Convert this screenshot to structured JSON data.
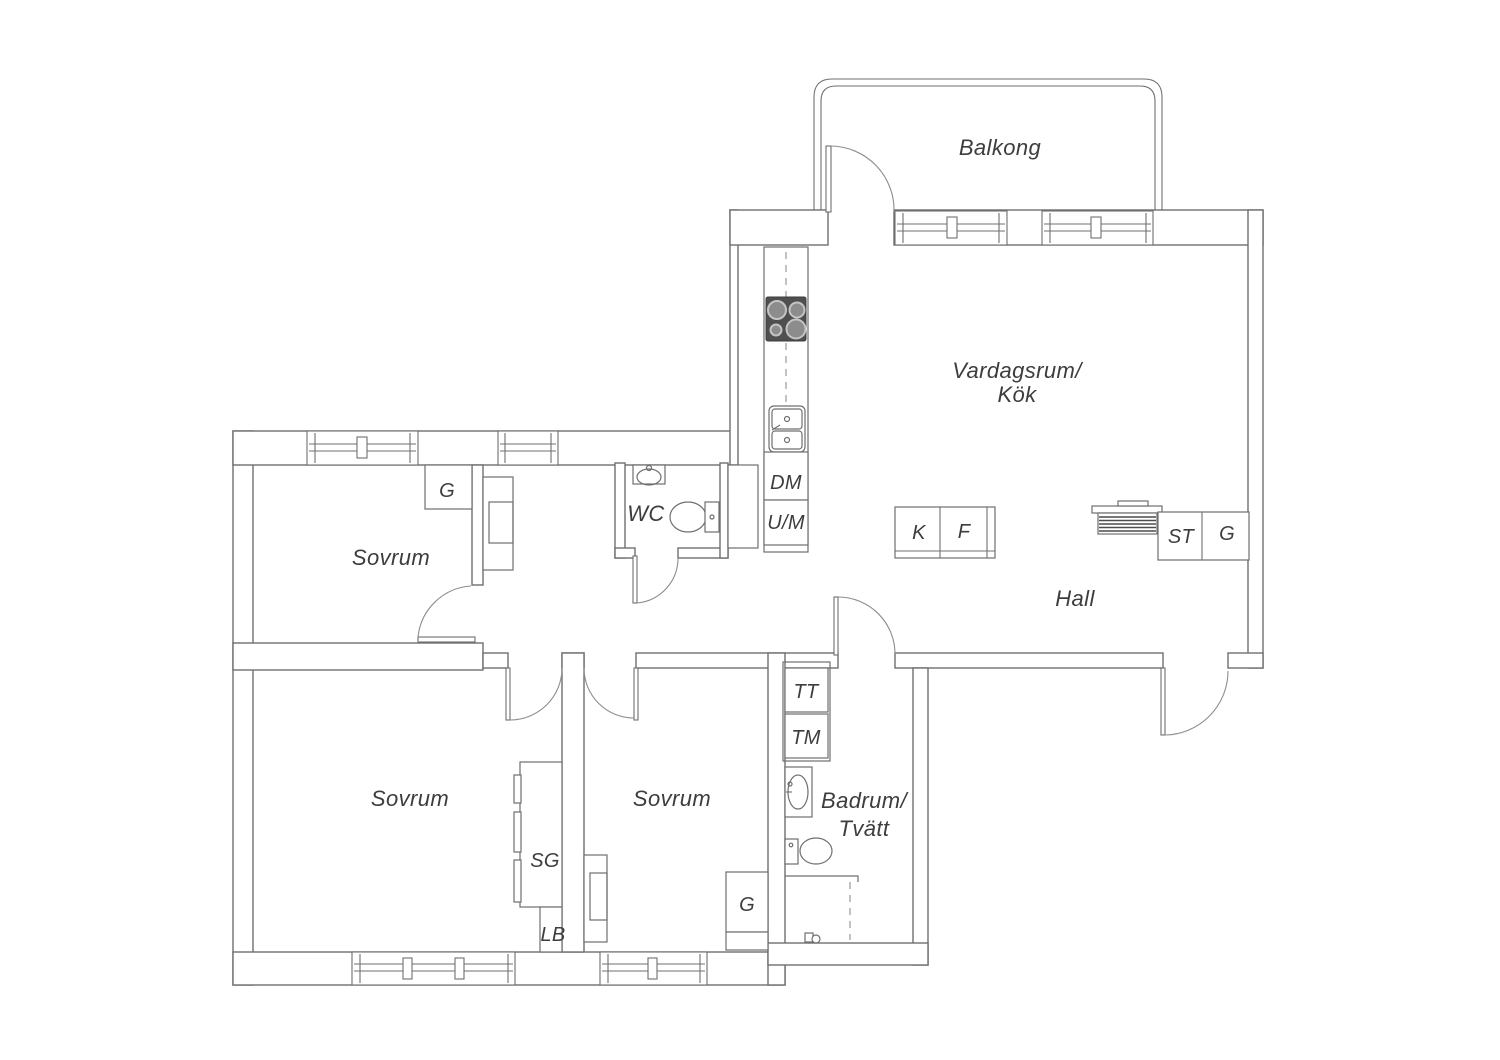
{
  "colors": {
    "background": "#ffffff",
    "wall_line": "#6f6f6f",
    "door_line": "#8d8d8d",
    "dashed_line": "#9a9a9a",
    "text": "#3d3d3d",
    "stove_body": "#4f4f4f",
    "stove_burner": "#8c8c8c"
  },
  "rooms": {
    "balcony": "Balkong",
    "living_kitchen_line1": "Vardagsrum/",
    "living_kitchen_line2": "Kök",
    "hall": "Hall",
    "wc": "WC",
    "bedroom1": "Sovrum",
    "bedroom2": "Sovrum",
    "bedroom3": "Sovrum",
    "bathroom_line1": "Badrum/",
    "bathroom_line2": "Tvätt"
  },
  "units": {
    "dishwasher": "DM",
    "oven_microwave": "U/M",
    "fridge": "K",
    "freezer": "F",
    "cleaning_cabinet": "ST",
    "wardrobe_hall": "G",
    "wardrobe_bedroom1": "G",
    "wardrobe_bedroom3": "G",
    "dryer": "TT",
    "washer": "TM",
    "sliding_wardrobe": "SG",
    "linen_cabinet": "LB"
  }
}
